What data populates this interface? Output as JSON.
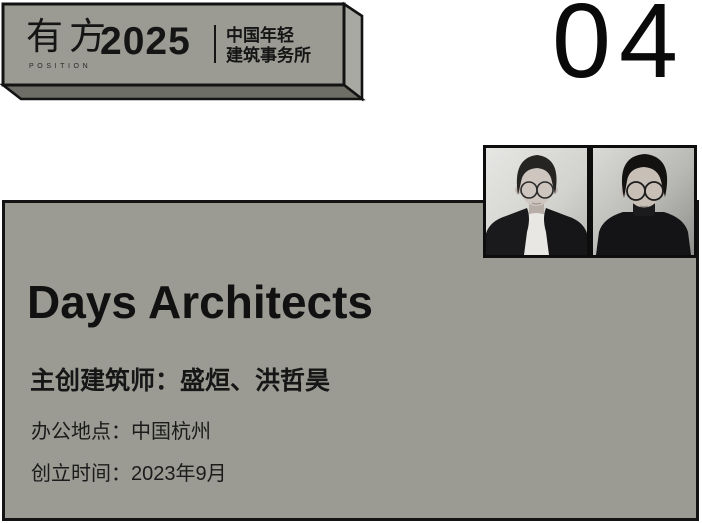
{
  "banner": {
    "logo_cn": "有方",
    "logo_en": "POSITION",
    "year": "2025",
    "series_line1": "中国年轻",
    "series_line2": "建筑事务所"
  },
  "page_number": "04",
  "card": {
    "firm_name": "Days Architects",
    "architects": "主创建筑师：盛烜、洪哲昊",
    "location": "办公地点：中国杭州",
    "founded": "创立时间：2023年9月"
  },
  "photos": [
    {
      "id": "portrait-left",
      "description": "black-and-white portrait, man with round glasses, dark blazer, white tee"
    },
    {
      "id": "portrait-right",
      "description": "black-and-white portrait, man with glasses, dark sweater"
    }
  ],
  "colors": {
    "panel_gray": "#9b9b94",
    "panel_side_light": "#a9a9a3",
    "panel_bottom_dark": "#6e6e66",
    "ink": "#131313",
    "background": "#ffffff"
  }
}
